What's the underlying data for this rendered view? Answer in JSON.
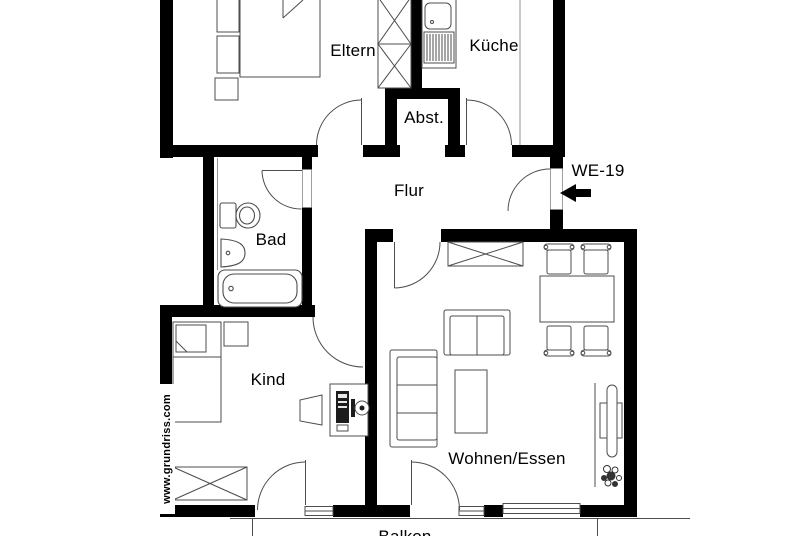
{
  "plan": {
    "unit_label": "WE-19",
    "watermark": "www.grundriss.com",
    "rooms": {
      "eltern": "Eltern",
      "kueche": "Küche",
      "abstellraum": "Abst.",
      "flur": "Flur",
      "bad": "Bad",
      "kind": "Kind",
      "wohnen_essen": "Wohnen/Essen",
      "balkon": "Balkon"
    },
    "colors": {
      "wall": "#000000",
      "furniture_line": "#4d4d4d",
      "background": "#ffffff"
    }
  }
}
